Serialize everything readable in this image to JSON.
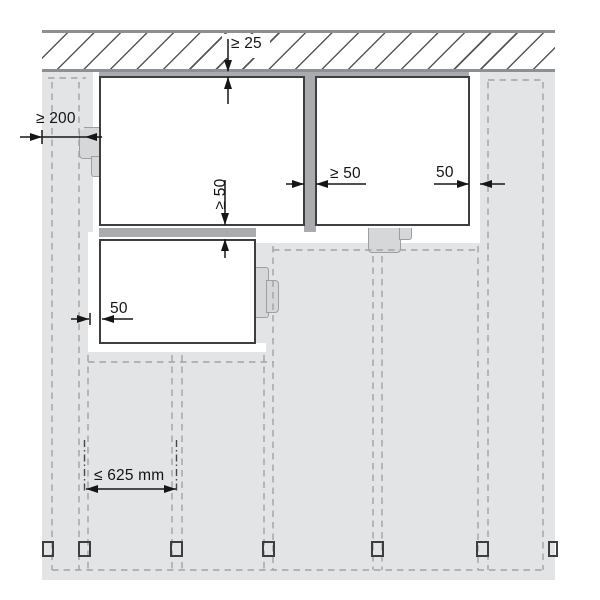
{
  "diagram": {
    "kind": "panel-installation-clearance-diagram",
    "labels": {
      "top_clearance": "≥ 25",
      "left_edge_distance": "≥ 200",
      "vertical_joint_gap": "≥ 50",
      "right_overhang": "50",
      "horizontal_joint_gap": "≥ 50",
      "left_overhang": "50",
      "support_spacing": "≤ 625 mm"
    },
    "elements": {
      "ceiling_band": "hatched ceiling section",
      "substrate": "wall substrate with battens",
      "panel_count": 3,
      "fastener_clip_count": 3,
      "batten_line_count": 5,
      "batten_section_mark_count": 7
    },
    "colors": {
      "background": "#ffffff",
      "substrate": "#e3e4e6",
      "joint_rail": "#a9abae",
      "clip_fill": "#d5d7d9",
      "panel_border": "#3c3e40",
      "dashed_line": "#9fa4aa",
      "hatch_line": "#54575b",
      "dimension": "#161616"
    }
  }
}
